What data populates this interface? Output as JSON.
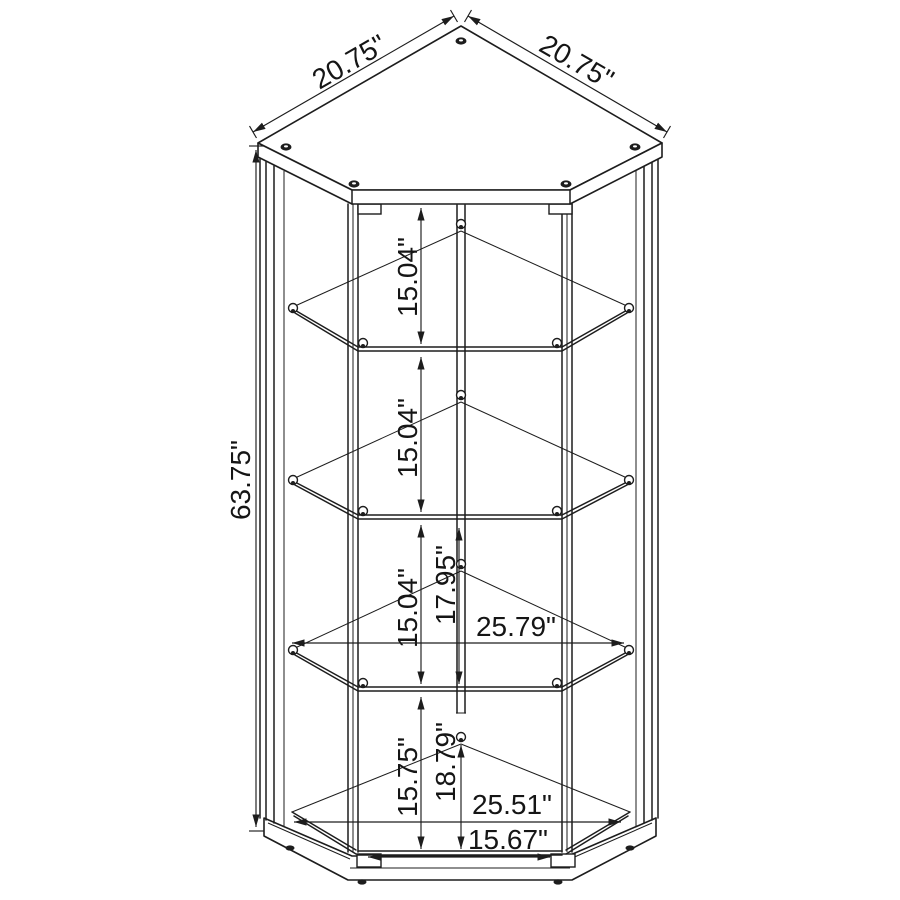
{
  "colors": {
    "line": "#1d1d1d",
    "background": "#ffffff"
  },
  "diagram": {
    "type": "furniture dimension drawing",
    "subject": "corner curio display cabinet with glass shelves",
    "units": "inches",
    "dimensions": {
      "top_edge_left": "20.75\"",
      "top_edge_right": "20.75\"",
      "overall_height": "63.75\"",
      "shelf_spacing_1": "15.04\"",
      "shelf_spacing_2": "15.04\"",
      "shelf_spacing_3": "15.04\"",
      "back_spacing_lower_shelf": "17.95\"",
      "interior_width_shelf": "25.79\"",
      "bottom_section_front": "15.75\"",
      "bottom_section_back": "18.79\"",
      "interior_width_base": "25.51\"",
      "door_opening_width": "15.67\""
    }
  }
}
